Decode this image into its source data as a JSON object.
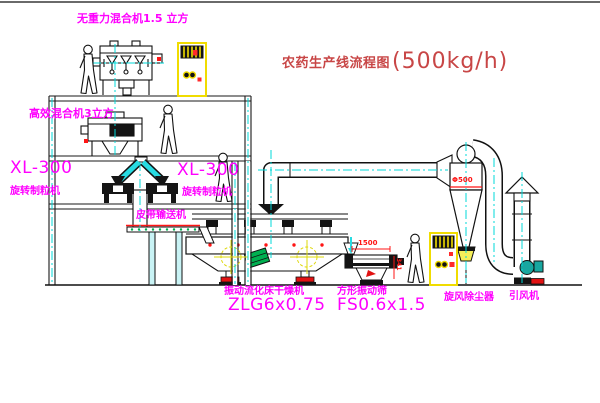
{
  "title": {
    "name": "农药生产线流程图",
    "capacity": "(500kg/h)"
  },
  "labels": {
    "gravity_mixer": "无重力混合机1.5 立方",
    "high_eff_mixer": "高效混合机3立方",
    "granulator_left_model": "XL-300",
    "granulator_left_name": "旋转制粒机",
    "granulator_right_model": "XL-300",
    "granulator_right_name": "旋转制粒机",
    "belt_conveyor": "皮带输送机",
    "fluid_bed_dryer_name": "振动流化床干燥机",
    "fluid_bed_dryer_model": "ZLG6x0.75",
    "square_sieve_name": "方形振动筛",
    "square_sieve_model": "FS0.6x1.5",
    "cyclone_name": "旋风除尘器",
    "fan_name": "引风机"
  },
  "dimensions": {
    "sieve_length": "1500",
    "sieve_height": "341",
    "cyclone_diameter": "Φ500"
  },
  "colors": {
    "label_magenta": "#ff00ff",
    "title_red": "#c84646",
    "centerline_cyan": "#00d9d9",
    "cabinet_yellow": "#f0dc00",
    "dimension_red": "#ff1515",
    "accent_green": "#00b050"
  }
}
